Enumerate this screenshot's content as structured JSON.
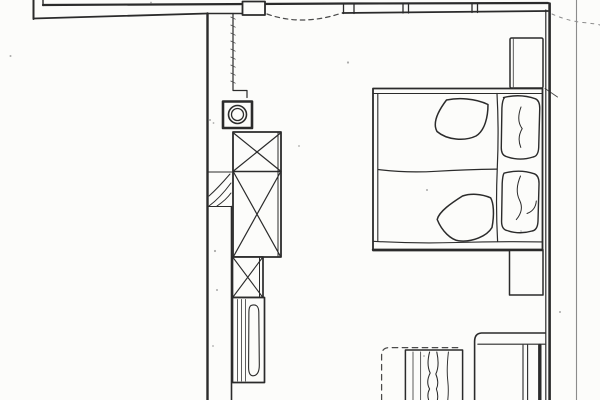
{
  "meta": {
    "kind": "scanned-floor-plan",
    "description": "Hand-drawn bedroom floor plan, black ink on white paper, no text labels visible"
  },
  "palette": {
    "paper": "#fcfcfa",
    "ink": "#2b2b2b",
    "ink_soft": "#4a4a4a",
    "ink_faint": "#8c8c8c"
  },
  "drawing": {
    "rooms": [
      "bedroom"
    ],
    "elements": [
      {
        "name": "top-wall",
        "desc": "thick double-line exterior wall across the top with left stub"
      },
      {
        "name": "door-swing-arc",
        "desc": "dashed shallow arc marking door opening in top wall"
      },
      {
        "name": "wall-duct-box",
        "desc": "small rectangular box embedded in top wall"
      },
      {
        "name": "wall-joint-ticks",
        "desc": "short double tick marks crossing the top wall"
      },
      {
        "name": "left-wall",
        "desc": "vertical wall line running to bottom edge with inner face line"
      },
      {
        "name": "wall-hatch-section",
        "desc": "diagonally hatched masonry section on left wall"
      },
      {
        "name": "vent-shaft",
        "desc": "heavy-bordered square with concentric circular duct"
      },
      {
        "name": "wardrobe",
        "desc": "tall cabinet with two crossed-diagonal (X) sections"
      },
      {
        "name": "crossed-cabinet",
        "desc": "small square cabinet with X"
      },
      {
        "name": "striped-unit",
        "desc": "narrow unit with vertical stripes and elongated loop"
      },
      {
        "name": "double-bed",
        "desc": "large bed, two mattresses divided by wavy line"
      },
      {
        "name": "pillow-top",
        "desc": "upper pillow with fold squiggle"
      },
      {
        "name": "pillow-bottom",
        "desc": "lower pillow with fold squiggle"
      },
      {
        "name": "duvet-top",
        "desc": "folded duvet corner blob on upper mattress"
      },
      {
        "name": "duvet-bottom",
        "desc": "folded duvet corner blob on lower mattress"
      },
      {
        "name": "nightstand-top",
        "desc": "rectangle between bed head and top wall"
      },
      {
        "name": "nightstand-bottom",
        "desc": "rectangle below bed foot against right wall"
      },
      {
        "name": "right-wall",
        "desc": "double vertical wall at right"
      },
      {
        "name": "page-edge-line",
        "desc": "thin scan/page boundary line at far right"
      },
      {
        "name": "bench-seat",
        "desc": "built-in bench with lip and dark rail, bottom right"
      },
      {
        "name": "small-striped-bed",
        "desc": "striped piece with wavy blanket lines, bottom centre"
      },
      {
        "name": "hidden-edge-dashed",
        "desc": "dashed hidden outline, bottom centre"
      },
      {
        "name": "scan-artifacts",
        "desc": "faint dashes and speckles from scanning"
      }
    ]
  }
}
